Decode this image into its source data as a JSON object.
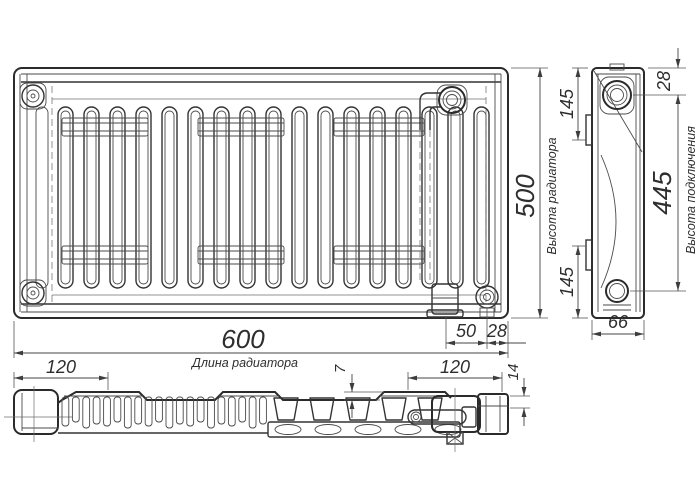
{
  "drawing": {
    "title": "panel-radiator-technical-drawing",
    "dimensions": {
      "length": {
        "value": "600",
        "label": "Длина радиатора"
      },
      "height": {
        "value": "500",
        "label": "Высота радиатора"
      },
      "connection": {
        "value": "445",
        "label": "Высота подключения"
      },
      "top_offset": {
        "value": "28"
      },
      "bracket_top": {
        "value": "145"
      },
      "bracket_bottom": {
        "value": "145"
      },
      "pipe_spacing": {
        "value": "50"
      },
      "pipe_edge": {
        "value": "28"
      },
      "depth": {
        "value": "66"
      },
      "bracket_left": {
        "value": "120"
      },
      "bracket_right": {
        "value": "120"
      },
      "fin_step": {
        "value": "7"
      },
      "stub_height": {
        "value": "14"
      }
    },
    "colors": {
      "line": "#333333",
      "dim_line": "#444444",
      "text": "#2e2e2e",
      "background": "#ffffff"
    }
  }
}
